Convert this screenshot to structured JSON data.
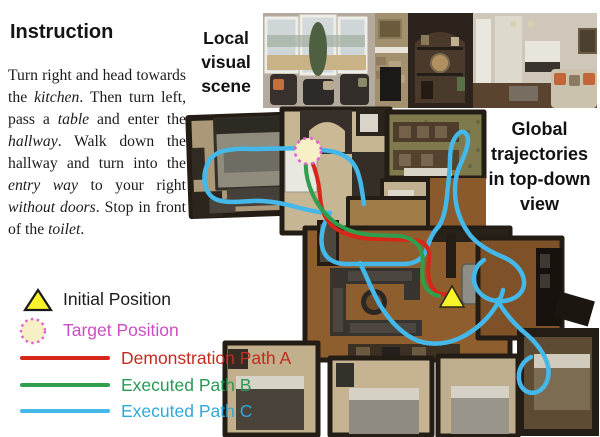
{
  "instruction": {
    "heading": "Instruction",
    "segments": [
      {
        "text": "Turn right and head towards the ",
        "italic": false
      },
      {
        "text": "kitchen",
        "italic": true
      },
      {
        "text": ". Then turn left, pass a ",
        "italic": false
      },
      {
        "text": "table",
        "italic": true
      },
      {
        "text": " and enter the ",
        "italic": false
      },
      {
        "text": "hallway",
        "italic": true
      },
      {
        "text": ". Walk down the hallway and turn into the ",
        "italic": false
      },
      {
        "text": "entry way",
        "italic": true
      },
      {
        "text": " to your right ",
        "italic": false
      },
      {
        "text": "without doors",
        "italic": true
      },
      {
        "text": ". Stop in front of the ",
        "italic": false
      },
      {
        "text": "toilet",
        "italic": true
      },
      {
        "text": ".",
        "italic": false
      }
    ]
  },
  "local_scene_label": {
    "lines": [
      "Local",
      "visual",
      "scene"
    ]
  },
  "global_label": {
    "lines": [
      "Global",
      "trajectories",
      "in top-down",
      "view"
    ]
  },
  "legend": {
    "items": [
      {
        "label": "Initial Position",
        "marker": "triangle",
        "fill": "#f8f32b",
        "stroke": "#1a1a1a",
        "text_color": "#1b1b1b"
      },
      {
        "label": "Target Position",
        "marker": "dashed-circle",
        "fill": "#f7f0c6",
        "stroke": "#e05fd2",
        "text_color": "#cb4ec4"
      },
      {
        "label": "Demonstration Path A",
        "marker": "line",
        "color": "#d8261a",
        "text_color": "#c32b20"
      },
      {
        "label": "Executed Path B",
        "marker": "line",
        "color": "#2f9f4e",
        "text_color": "#279a55"
      },
      {
        "label": "Executed Path C",
        "marker": "line",
        "color": "#44b8e8",
        "text_color": "#2fa9d9"
      }
    ]
  },
  "map": {
    "markers": {
      "initial": {
        "points": "452,286 440,307 464,307",
        "fill": "#f8f32b",
        "stroke": "#2a2a14"
      },
      "target": {
        "cx": "308",
        "cy": "151",
        "r": "13",
        "fill": "#f7f0c6",
        "stroke": "#e05fd2"
      }
    },
    "paths": {
      "demonstration_a": {
        "color": "#d8261a",
        "d": "M 310,157 C 315,168 319,181 320,196 C 321,211 326,223 338,230 C 350,237 364,239 378,239 L 414,240 C 425,241 430,248 429,258 C 428,269 427,278 432,287 C 436,293 441,295 446,294"
      },
      "executed_b": {
        "color": "#2f9f4e",
        "d": "M 306,160 C 305,172 308,184 313,195 C 318,206 326,216 337,224 C 348,231 360,234 372,235 L 400,236 C 412,238 420,244 422,254 C 424,264 421,272 423,281 C 425,289 431,294 439,296"
      },
      "executed_c": {
        "color": "#44b8e8",
        "d": "M 307,148 L 252,149 C 233,148 215,150 209,161 C 203,172 202,187 211,196 C 219,204 237,202 252,201 C 268,200 286,204 300,208 C 312,211 322,213 330,213 C 324,222 320,234 322,246 C 324,257 332,263 344,264 L 404,264 C 416,264 424,258 427,248 C 430,238 434,231 439,226 C 444,218 446,207 447,196 C 448,184 450,172 450,160 C 450,150 452,140 458,134 C 463,129 468,133 468,141 C 467,151 462,160 458,170 C 455,180 454,191 456,203 C 458,215 463,226 470,235 C 478,245 491,252 503,257 C 515,262 523,271 524,281 C 525,292 516,300 503,301 C 490,302 479,296 475,285 C 472,275 476,265 484,260 M 321,150 C 338,151 350,156 356,168 C 361,179 362,192 364,204 M 360,263 C 367,277 372,291 380,305 C 388,318 398,330 412,338 C 426,346 445,345 460,338 C 473,332 486,321 494,309 C 499,302 502,296 503,290 M 497,300 C 505,313 514,324 525,333 C 536,342 545,354 548,366 C 550,378 546,388 537,392 C 528,395 520,389 519,379 C 518,369 523,361 531,357"
      }
    }
  }
}
